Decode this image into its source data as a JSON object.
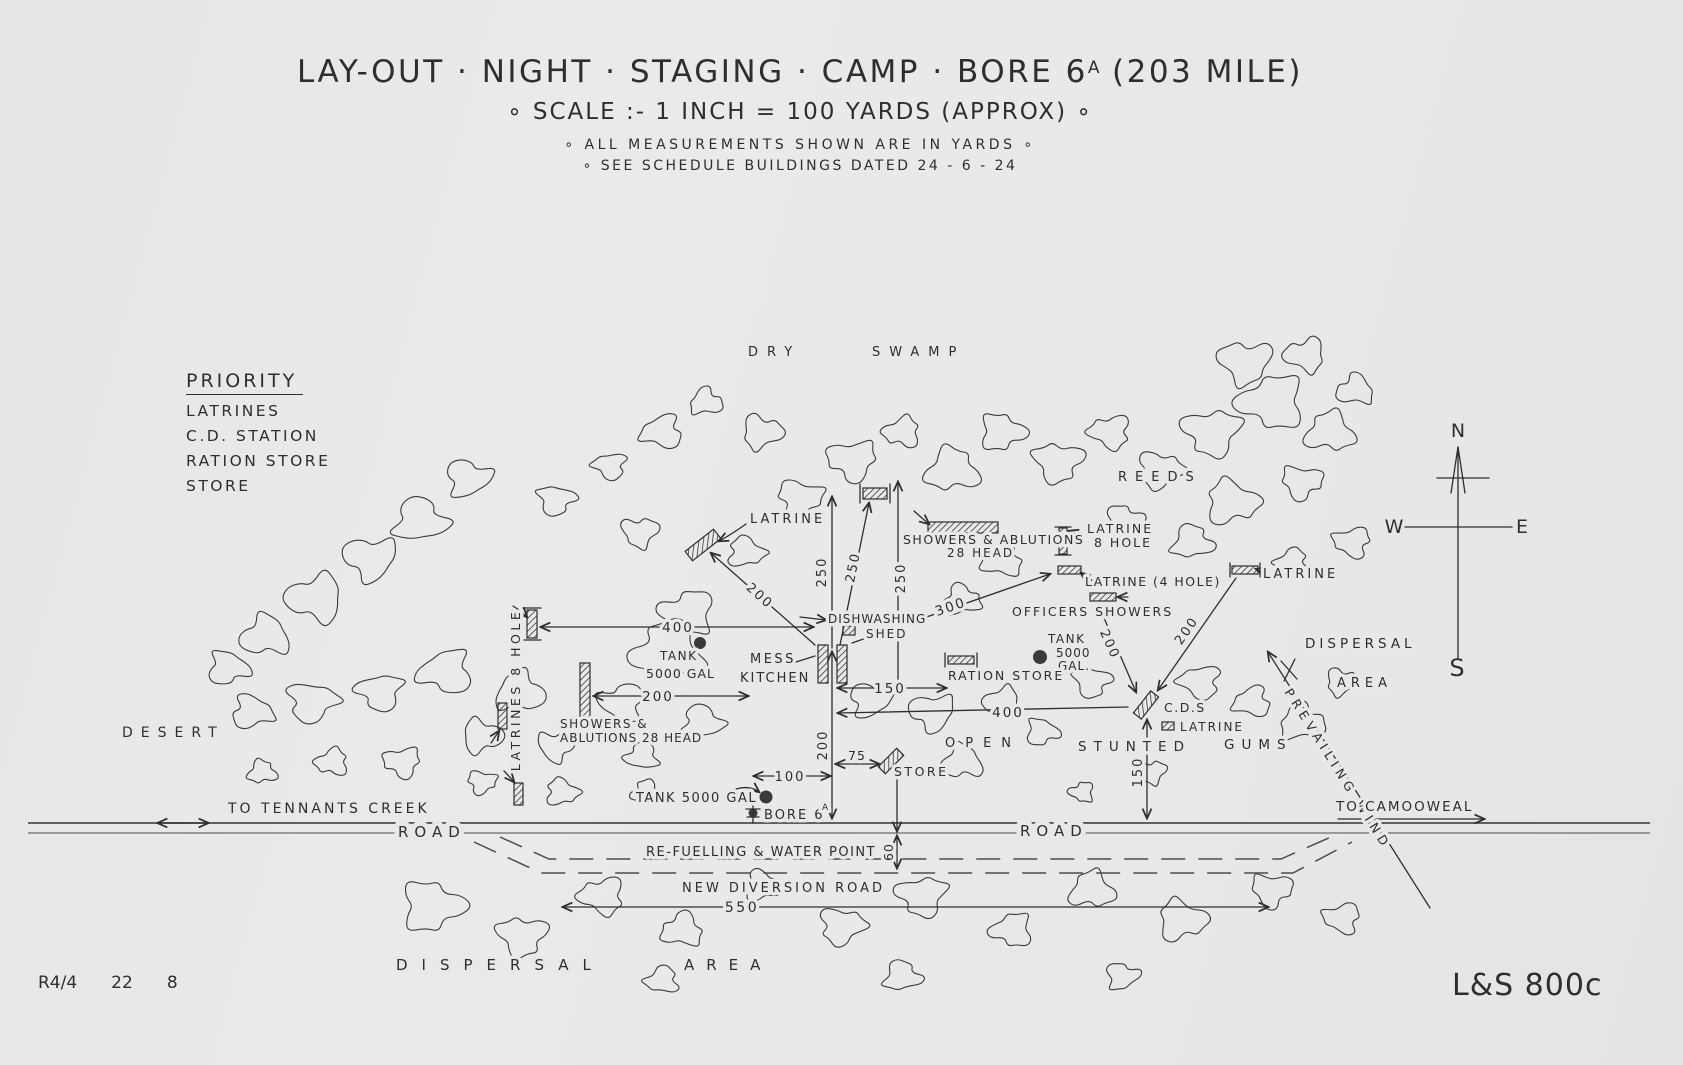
{
  "header": {
    "title_main": "LAY-OUT · NIGHT · STAGING · CAMP · BORE 6",
    "title_sup": "A",
    "title_tail": "(203 MILE)",
    "scale_line": "∘   SCALE :-  1 INCH  =  100 YARDS (APPROX)   ∘",
    "note_measurements": "∘ ALL MEASUREMENTS  SHOWN  ARE  IN  YARDS ∘",
    "note_schedule": "∘ SEE SCHEDULE BUILDINGS  DATED  24 - 6 - 24"
  },
  "priority": {
    "heading": "PRIORITY",
    "items": [
      "LATRINES",
      "C.D. STATION",
      "RATION STORE",
      "STORE"
    ]
  },
  "regions": {
    "dry": "DRY",
    "swamp": "SWAMP",
    "reeds": "REEDS",
    "desert": "DESERT",
    "open": "OPEN",
    "stunted": "STUNTED",
    "gums": "GUMS",
    "dispersal_right_1": "DISPERSAL",
    "dispersal_right_2": "AREA",
    "dispersal_bottom_1": "DISPERSAL",
    "dispersal_bottom_2": "AREA",
    "prevailing_wind": "PREVAILING  WIND"
  },
  "roads": {
    "road_left": "ROAD",
    "road_right": "ROAD",
    "to_tennants_creek": "TO TENNANTS CREEK",
    "to_camooweal": "TO CAMOOWEAL",
    "refuelling": "RE-FUELLING & WATER POINT",
    "new_diversion": "NEW DIVERSION ROAD"
  },
  "features": {
    "latrine_nw": "LATRINE",
    "showers_n_1": "SHOWERS & ABLUTIONS",
    "showers_n_2": "28 HEAD",
    "latrine_8hole_1": "LATRINE",
    "latrine_8hole_2": "8 HOLE",
    "latrine_4hole": "LATRINE (4 HOLE)",
    "officers_showers": "OFFICERS   SHOWERS",
    "latrine_e": "LATRINE",
    "dishwashing_1": "DISHWASHING",
    "dishwashing_2": "SHED",
    "mess_1": "MESS",
    "mess_2": "KITCHEN",
    "tank_w_1": "TANK",
    "tank_w_2": "5000 GAL",
    "tank_e_1": "TANK",
    "tank_e_2": "5000",
    "tank_e_3": "GAL.",
    "ration_store": "RATION STORE",
    "cds": "C.D.S",
    "latrine_cds": "LATRINE",
    "latrines_8hole_w": "LATRINES 8 HOLE",
    "showers_w_1": "SHOWERS &",
    "showers_w_2": "ABLUTIONS 28 HEAD",
    "store": "STORE",
    "tank_bore": "TANK 5000 GAL",
    "bore_main": "BORE 6",
    "bore_sup": "A"
  },
  "dims": {
    "d250a": "250",
    "d250b": "250",
    "d250c": "250",
    "d200nw": "200",
    "d200w": "200",
    "d200v": "200",
    "d200o": "200",
    "d200e": "200",
    "d300": "300",
    "d400w": "400",
    "d400e": "400",
    "d150h": "150",
    "d150v": "150",
    "d100": "100",
    "d75": "75",
    "d550": "550",
    "d60": "60"
  },
  "compass": {
    "n": "N",
    "e": "E",
    "s": "S",
    "w": "W"
  },
  "corner": {
    "ref_1": "R4/4",
    "ref_2": "22",
    "ref_3": "8",
    "sheet_no": "L&S 800c"
  },
  "colors": {
    "paper": "#e8e8e6",
    "ink": "#2e2e2e"
  }
}
